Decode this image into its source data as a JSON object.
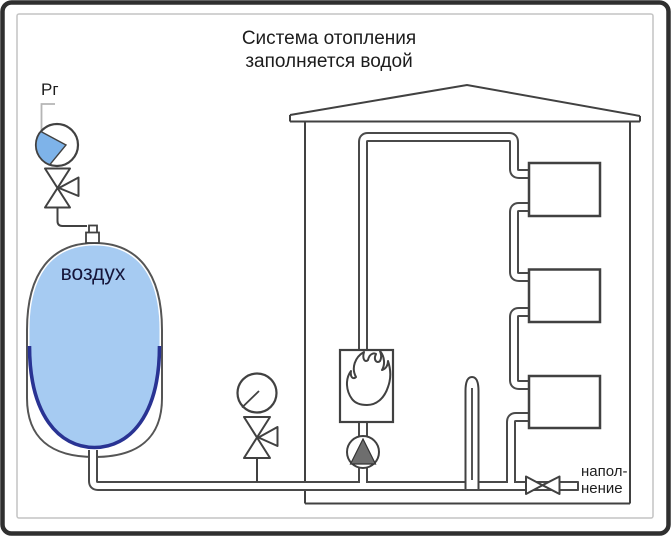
{
  "title": "Система отопления\nзаполняется водой",
  "labels": {
    "pressure_gauge": "Рг",
    "tank": "воздух",
    "fill_connection": "напол-\nнение"
  },
  "diagram": {
    "radiator_count": 3,
    "components": [
      "pressure-gauge",
      "three-way-valve",
      "expansion-tank",
      "house",
      "supply-pipe",
      "radiators",
      "boiler-with-flame",
      "circulation-pump",
      "check-pressure-gauge-with-valve",
      "overflow-tube",
      "fill-valve",
      "fill-stub"
    ]
  },
  "colors": {
    "tank_fill": "#a6cbf2",
    "membrane": "#293393",
    "gauge_wedge": "#7eb3e9",
    "line": "#414141",
    "pipe": "#4a4a4a",
    "border_outer": "#2f2f2f",
    "border_inner": "#c4c4c4"
  }
}
